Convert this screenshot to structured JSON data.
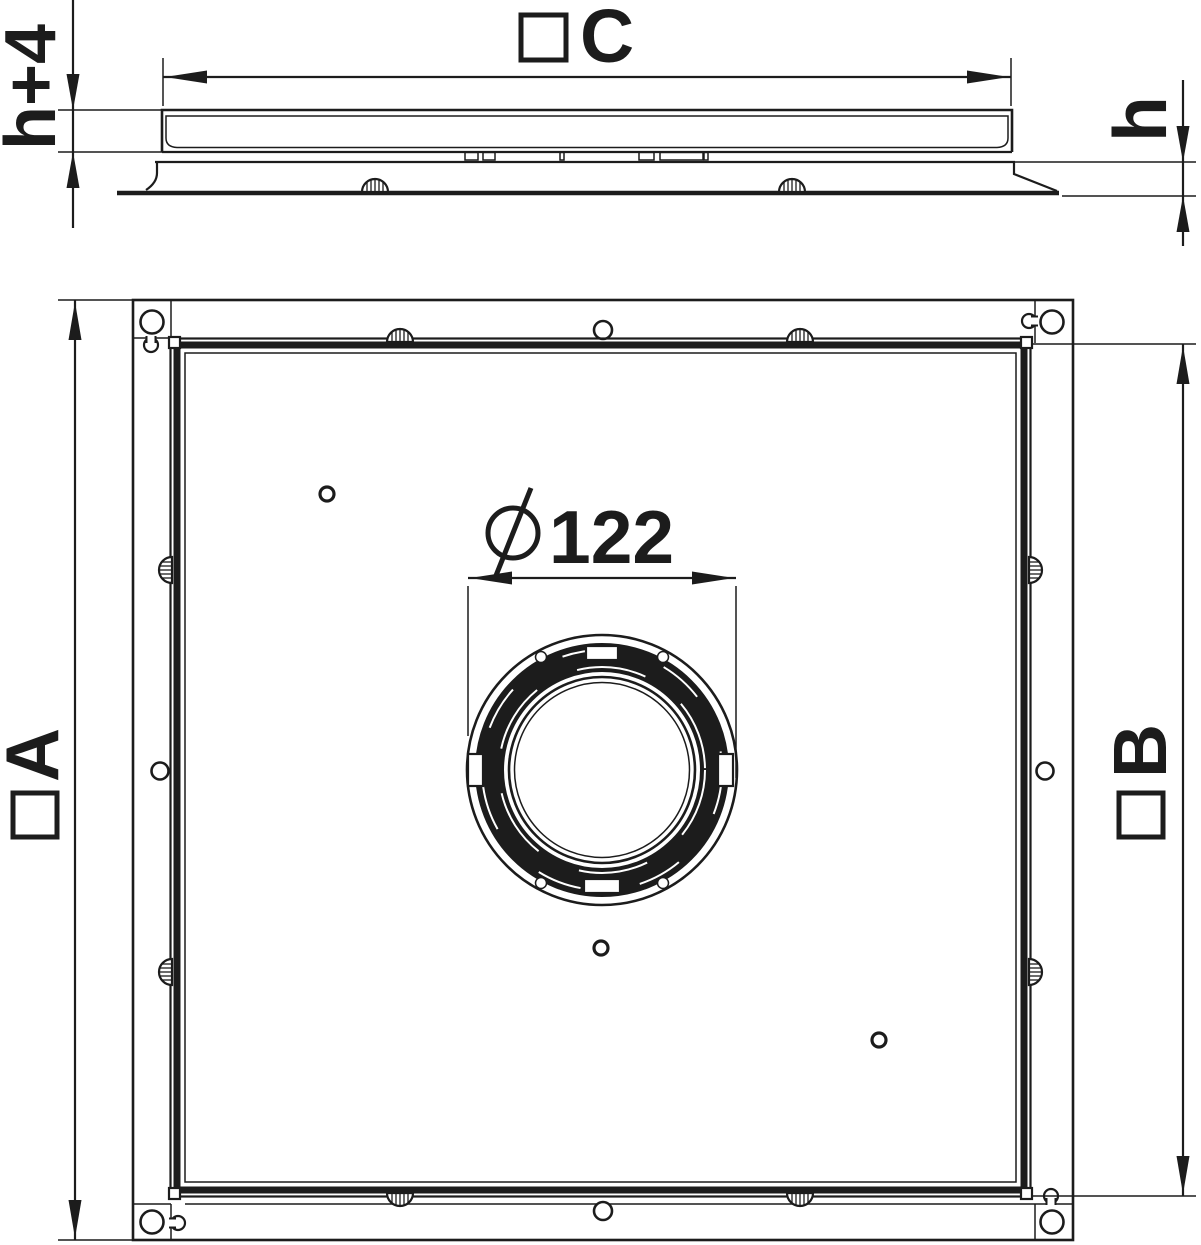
{
  "drawing": {
    "dimensions": {
      "cover_height": {
        "label": "h+4"
      },
      "cover_width": {
        "symbol": "square-symbol",
        "label": "C"
      },
      "frame_height": {
        "label": "h"
      },
      "outer_width": {
        "symbol": "square-symbol",
        "label": "A"
      },
      "inner_width": {
        "symbol": "square-symbol",
        "label": "B"
      },
      "center_opening": {
        "symbol": "diameter-symbol",
        "label": "122"
      }
    },
    "colors": {
      "line": "#1c1c1c",
      "background": "#ffffff"
    }
  }
}
